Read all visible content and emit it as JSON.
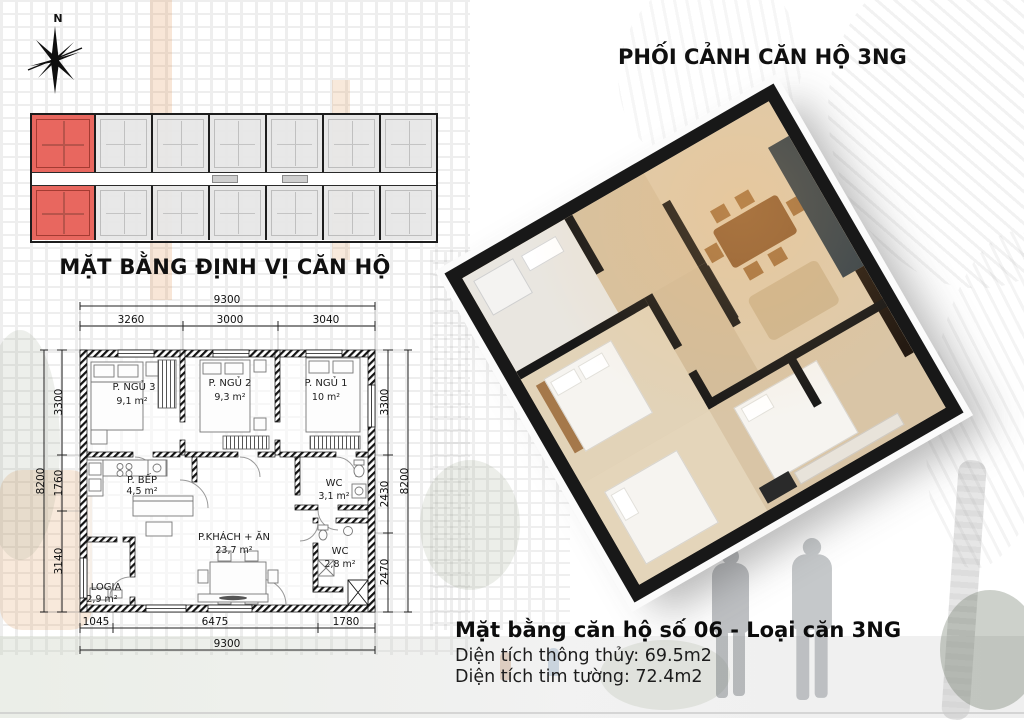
{
  "compass": {
    "north_label": "N"
  },
  "location_plan": {
    "title": "MẶT BẰNG ĐỊNH VỊ CĂN HỘ"
  },
  "perspective": {
    "title": "PHỐI CẢNH CĂN HỘ 3NG"
  },
  "colors": {
    "highlight_unit": "#e8675f"
  },
  "floor_plan": {
    "rooms": [
      {
        "name": "P. NGỦ 3",
        "area": "9,1 m²"
      },
      {
        "name": "P. NGỦ 2",
        "area": "9,3 m²"
      },
      {
        "name": "P. NGỦ 1",
        "area": "10 m²"
      },
      {
        "name": "P. BẾP",
        "area": "4,5 m²"
      },
      {
        "name": "WC",
        "area": "3,1 m²"
      },
      {
        "name": "P.KHÁCH + ĂN",
        "area": "23,7 m²"
      },
      {
        "name": "WC",
        "area": "2,8 m²"
      },
      {
        "name": "LOGIA",
        "area": "2,9 m²"
      }
    ],
    "dims": {
      "top_total": "9300",
      "top_segments": [
        "3260",
        "3000",
        "3040"
      ],
      "bottom_segments": [
        "1045",
        "6475",
        "1780"
      ],
      "bottom_total": "9300",
      "left_total": "8200",
      "left_segments": [
        "3300",
        "1760",
        "3140"
      ],
      "right_segments": [
        "3300",
        "2430",
        "2470"
      ],
      "right_total": "8200"
    }
  },
  "unit_info": {
    "title": "Mặt bằng căn hộ số 06 - Loại căn 3NG",
    "net_area": "Diện tích thông thủy: 69.5m2",
    "gross_area": "Diện tích tim tường: 72.4m2"
  }
}
